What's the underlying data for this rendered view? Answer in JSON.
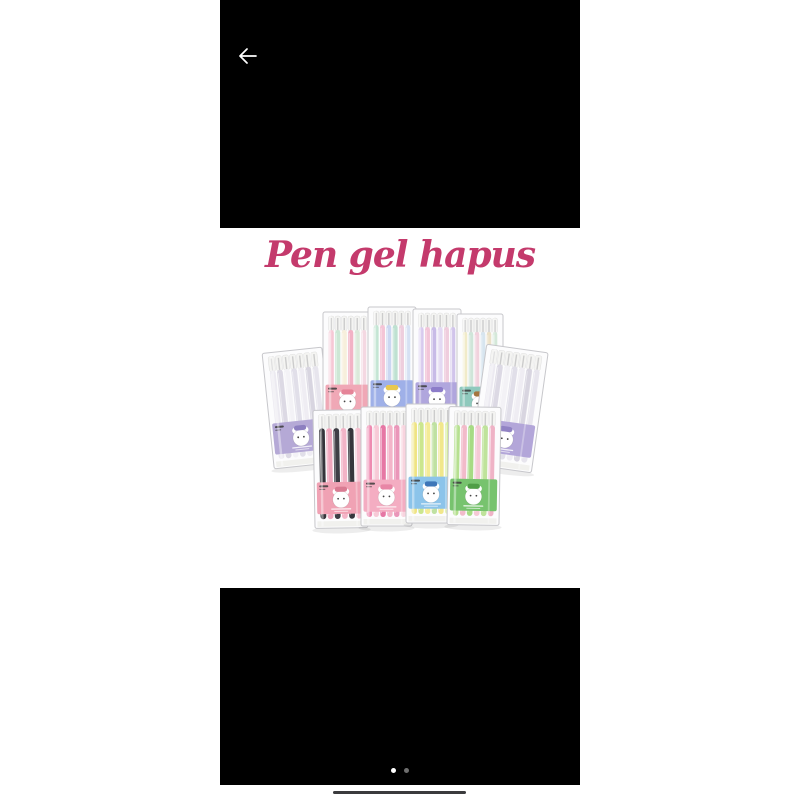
{
  "header": {
    "back_icon": "arrow-left"
  },
  "photo": {
    "title": "Pen gel hapus",
    "title_color": "#c43a6c",
    "background": "#ffffff",
    "packs": [
      {
        "x": 48,
        "y": 122,
        "w": 60,
        "h": 116,
        "rot": -6,
        "label": "#b5a9d6",
        "accent": "#8d7fc0",
        "pens": [
          "#eceaf1",
          "#dcd9e4",
          "#f3f2f6",
          "#e1dfe9",
          "#efedf3",
          "#d8d5e0",
          "#e7e5ed"
        ]
      },
      {
        "x": 103,
        "y": 84,
        "w": 49,
        "h": 119,
        "rot": 0,
        "label": "#f0a8b6",
        "accent": "#e58498",
        "pens": [
          "#f6c8d5",
          "#cde7d5",
          "#f7efdc",
          "#f2b2c5",
          "#dbe9da",
          "#f4d8e2"
        ]
      },
      {
        "x": 148,
        "y": 79,
        "w": 48,
        "h": 120,
        "rot": 0,
        "label": "#9fb0e8",
        "accent": "#e8c84f",
        "pens": [
          "#c3e5d3",
          "#f4c5d6",
          "#cbd7f1",
          "#bee1d1",
          "#eecedd",
          "#d6e1f3"
        ]
      },
      {
        "x": 193,
        "y": 81,
        "w": 48,
        "h": 120,
        "rot": 0,
        "label": "#b0a6dd",
        "accent": "#8c7cc9",
        "pens": [
          "#d7caee",
          "#f2c5d8",
          "#c8bbe7",
          "#e3d9f3",
          "#efcddd",
          "#d1c4eb"
        ]
      },
      {
        "x": 237,
        "y": 86,
        "w": 46,
        "h": 119,
        "rot": 0,
        "label": "#8fc9bd",
        "accent": "#a4763f",
        "pens": [
          "#f1ebc9",
          "#cfe5d9",
          "#f1d2dd",
          "#d7e5ef",
          "#ebe1c8",
          "#d4e8d9"
        ]
      },
      {
        "x": 258,
        "y": 120,
        "w": 62,
        "h": 121,
        "rot": 8,
        "label": "#b3a6d9",
        "accent": "#9183c4",
        "pens": [
          "#eceaf1",
          "#dcd9e4",
          "#f3f2f6",
          "#e1dfe9",
          "#efedf3",
          "#d8d5e0",
          "#e7e5ed"
        ]
      },
      {
        "x": 94,
        "y": 182,
        "w": 53,
        "h": 118,
        "rot": -1,
        "label": "#f0a2b4",
        "accent": "#d97b92",
        "pens": [
          "#34343a",
          "#f0a7bd",
          "#3e3e45",
          "#f3b4c7",
          "#36363c",
          "#f5bfcf"
        ]
      },
      {
        "x": 141,
        "y": 179,
        "w": 51,
        "h": 119,
        "rot": 0,
        "label": "#f4adc2",
        "accent": "#e886a6",
        "pens": [
          "#ee8bb1",
          "#f7cad7",
          "#e677a4",
          "#f3b5c9",
          "#ea96b9",
          "#f8d4df"
        ]
      },
      {
        "x": 186,
        "y": 176,
        "w": 50,
        "h": 119,
        "rot": 0,
        "label": "#8cc4ea",
        "accent": "#3d76b8",
        "pens": [
          "#efe483",
          "#cbe68d",
          "#f4eb96",
          "#bfe1a1",
          "#f1e78b",
          "#d4eb9b"
        ]
      },
      {
        "x": 228,
        "y": 179,
        "w": 52,
        "h": 118,
        "rot": 1,
        "label": "#77c36e",
        "accent": "#4f9e46",
        "pens": [
          "#b6e090",
          "#f2bbca",
          "#a7db84",
          "#f5c9d5",
          "#bfe39b",
          "#efb3c6"
        ]
      }
    ]
  },
  "pager": {
    "count": 2,
    "active_index": 0,
    "active_color": "#ffffff",
    "inactive_color": "#6e6e6e"
  },
  "system": {
    "letterbox_color": "#000000",
    "page_background": "#ffffff",
    "home_indicator_color": "#3b3b3d",
    "back_arrow_color": "#ffffff"
  }
}
